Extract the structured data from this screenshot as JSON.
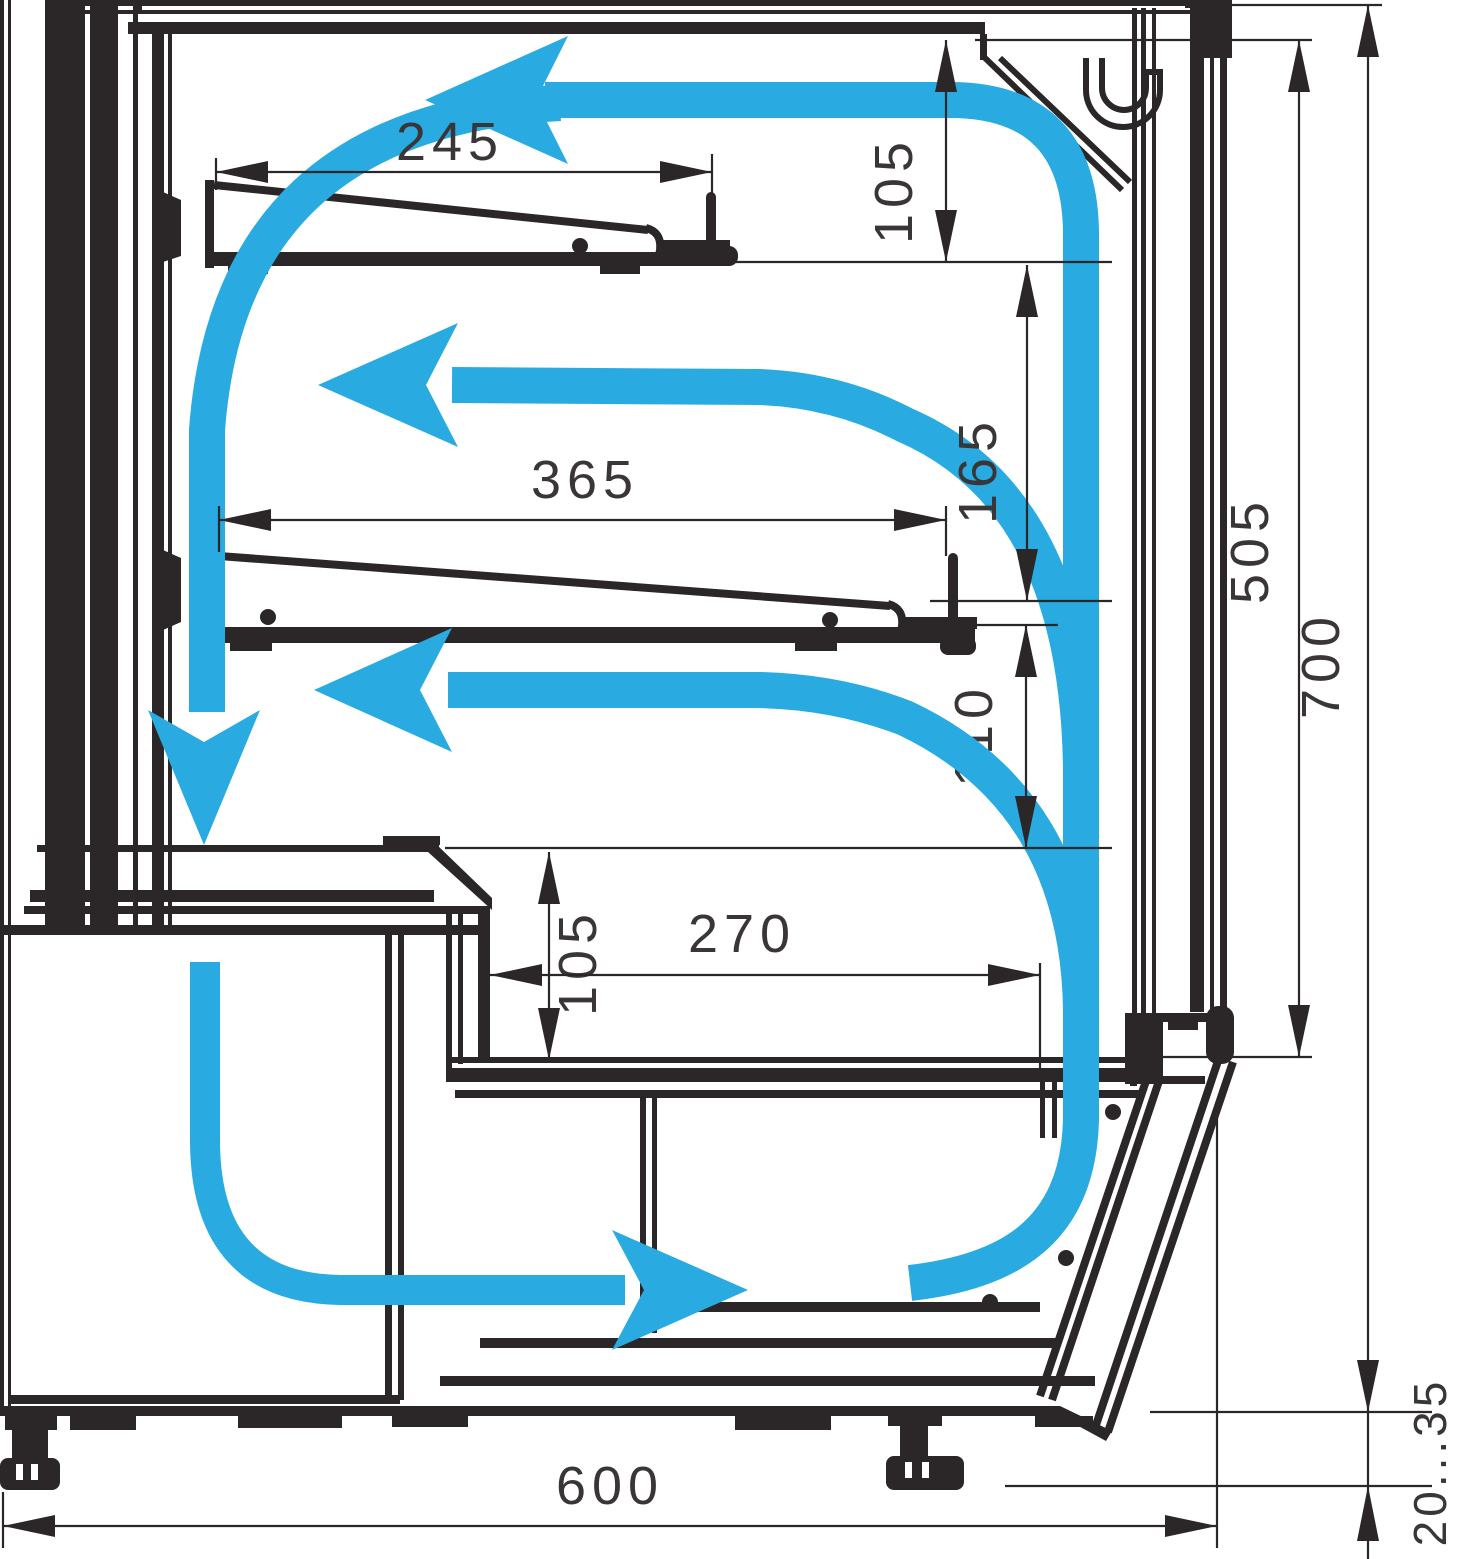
{
  "diagram": {
    "title": "Refrigerated display case cross-section with air circulation",
    "type": "technical-cross-section",
    "colors": {
      "line": "#2b2728",
      "airflow": "#29abe2",
      "background": "#ffffff",
      "dim_text": "#3a3637"
    },
    "dims": {
      "d245": "245",
      "d105_top": "105",
      "d365": "365",
      "d165": "165",
      "d505": "505",
      "d700": "700",
      "d110": "110",
      "d105_bottom": "105",
      "d270": "270",
      "d600": "600",
      "d20_35": "20...35"
    },
    "airflow": {
      "description": "recirculating cold air loop",
      "arrow_count": 5
    }
  }
}
